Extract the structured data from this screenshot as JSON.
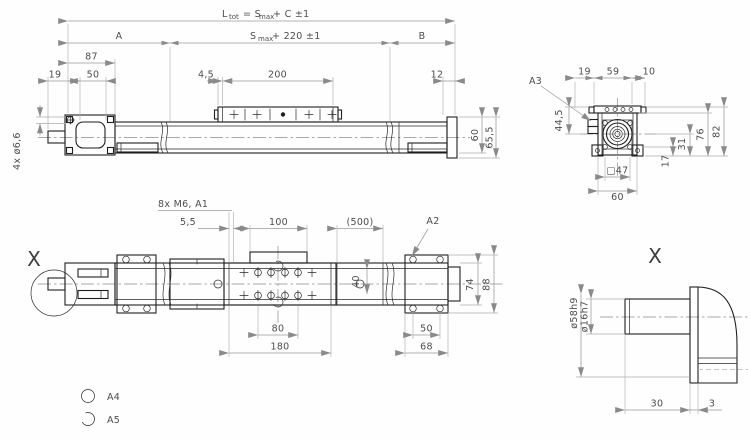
{
  "side": {
    "f_l": "L",
    "f_l_sub": "tot",
    "f_eq": "= S",
    "f_eq_sub": "max",
    "f_tail": "+ C  ±1",
    "seg_a": "A",
    "mid_s": "S",
    "mid_sub": "max",
    "mid_tail": "+ 220  ±1",
    "seg_b": "B",
    "d87": "87",
    "d19": "19",
    "d50": "50",
    "d45": "4,5",
    "d200": "200",
    "d12": "12",
    "holes": "4x ø6,6",
    "d60": "60",
    "d655": "65,5"
  },
  "end": {
    "a3": "A3",
    "d19": "19",
    "d59": "59",
    "d10": "10",
    "d445": "44,5",
    "d76": "76",
    "d82": "82",
    "d31": "31",
    "d17": "17",
    "d47": "□47",
    "d60": "60"
  },
  "bottom": {
    "x": "X",
    "a2": "A2",
    "note": "8x M6, A1",
    "d55": "5,5",
    "d100": "100",
    "d500": "(500)",
    "d40": "40",
    "d74": "74",
    "d88": "88",
    "d80": "80",
    "d180": "180",
    "d50": "50",
    "d68": "68"
  },
  "detail": {
    "x": "X",
    "d58": "ø58h9",
    "d16": "ø16h7",
    "d30": "30",
    "d3": "3"
  },
  "legend": {
    "a4": "A4",
    "a5": "A5"
  }
}
